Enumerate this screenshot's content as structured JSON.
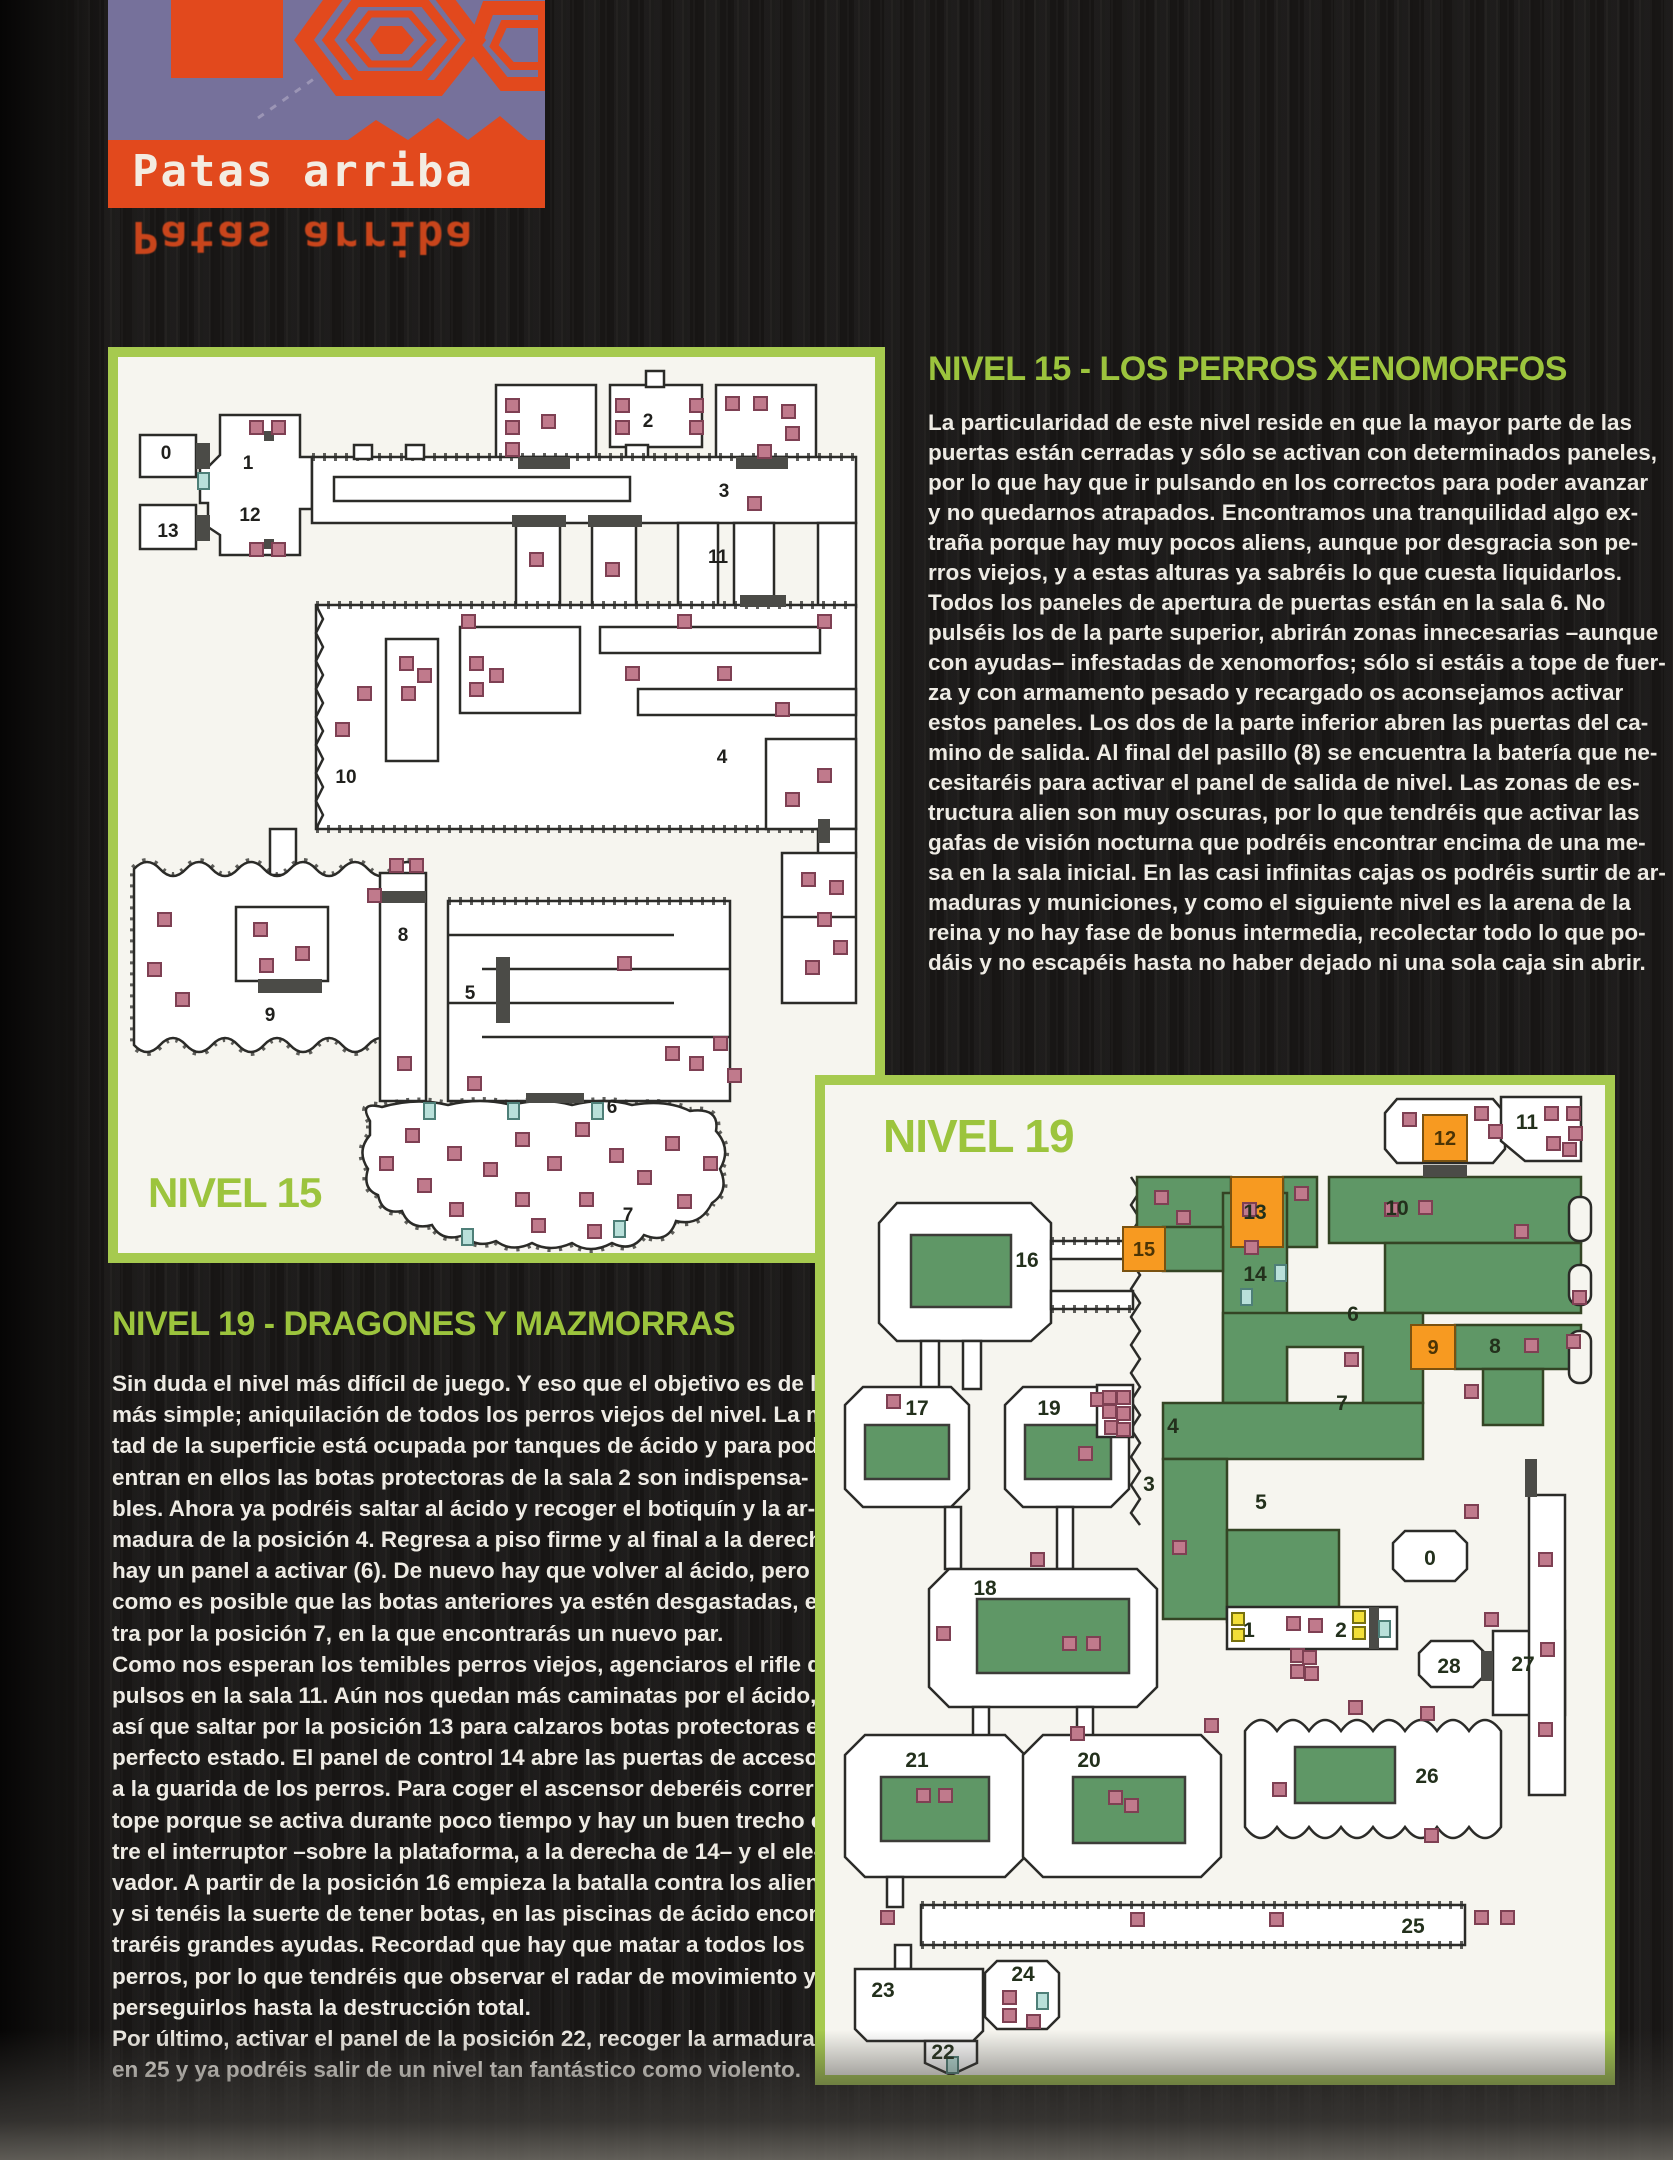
{
  "logo": {
    "title": "Patas arriba",
    "reflection": "Patas arriba"
  },
  "colors": {
    "accent_green": "#9cc43d",
    "map_frame_green": "#a6ca4f",
    "logo_orange": "#e2491d",
    "logo_purple": "#76719b",
    "acid_green": "#5f9766",
    "panel_orange": "#f79a21",
    "item_pink": "#c07a8c",
    "item_cyan": "#b9e0da",
    "item_yellow": "#f2df38",
    "body_text": "#eeebe4",
    "page_bg": "#1b1918"
  },
  "sections": {
    "nivel15": {
      "heading": "NIVEL 15 - LOS PERROS XENOMORFOS",
      "lines": [
        "La particularidad de este nivel reside en que la mayor parte de las",
        "puertas están cerradas y sólo se activan con determinados paneles,",
        "por lo que hay que ir pulsando en los correctos para poder avanzar",
        "y no quedarnos atrapados. Encontramos una tranquilidad algo ex-",
        "traña porque hay muy pocos aliens, aunque por desgracia son pe-",
        "rros viejos, y a estas alturas ya sabréis lo que cuesta liquidarlos.",
        "Todos los paneles de apertura de puertas están en la sala 6. No",
        "pulséis los de la parte superior, abrirán zonas innecesarias –aunque",
        "con ayudas– infestadas de xenomorfos; sólo si estáis a tope de fuer-",
        "za y con armamento pesado y recargado os aconsejamos activar",
        "estos paneles. Los dos de la parte inferior abren las puertas del ca-",
        "mino de salida. Al final del pasillo (8) se encuentra la batería que ne-",
        "cesitaréis para activar el panel de salida de nivel. Las zonas de es-",
        "tructura alien son muy oscuras, por lo que tendréis que activar las",
        "gafas de visión nocturna que podréis encontrar encima de una me-",
        "sa en la sala inicial. En las casi infinitas cajas os podréis surtir de ar-",
        "maduras y municiones, y como el siguiente nivel es la arena de la",
        "reina y no hay fase de bonus intermedia, recolectar todo lo que po-",
        "dáis y no escapéis hasta no haber dejado ni una sola caja sin abrir."
      ]
    },
    "nivel19": {
      "heading": "NIVEL 19 - DRAGONES Y MAZMORRAS",
      "lines": [
        "Sin duda el nivel más difícil de juego. Y eso que el objetivo es de lo",
        "más simple; aniquilación de todos los perros viejos del nivel. La mi-",
        "tad de la superficie está ocupada por tanques de ácido y para poder",
        "entran en ellos las botas protectoras de la sala 2 son indispensa-",
        "bles. Ahora ya podréis saltar al ácido y recoger el botiquín y la ar-",
        "madura de la posición 4. Regresa a piso firme y al final a la derecha",
        "hay un panel a activar (6). De nuevo hay que volver al ácido, pero",
        "como es posible que las botas anteriores ya estén desgastadas, en-",
        "tra por la posición 7, en la que encontrarás un nuevo par.",
        "Como nos esperan los temibles perros viejos, agenciaros el rifle de",
        "pulsos en la sala 11. Aún nos quedan más caminatas por el ácido,",
        "así que saltar por la posición 13 para calzaros botas protectoras en",
        "perfecto estado. El panel de control 14 abre las puertas de acceso",
        "a la guarida de los perros. Para coger el ascensor deberéis correr a",
        "tope porque se activa durante poco tiempo y hay un buen trecho en-",
        "tre el interruptor –sobre la plataforma, a la derecha de 14– y el ele-",
        "vador. A partir de la posición 16 empieza la batalla contra los aliens",
        "y si tenéis la suerte de tener botas, en las piscinas de ácido encon-",
        "traréis grandes ayudas. Recordad que hay que matar a todos los",
        "perros, por lo que tendréis que observar el radar de movimiento y",
        "perseguirlos hasta la destrucción total.",
        "Por último, activar el panel de la posición 22, recoger la armadura",
        "en 25 y ya podréis salir de un nivel tan fantástico como violento."
      ]
    }
  },
  "map15": {
    "label": "NIVEL 15",
    "rooms": [
      {
        "n": "0",
        "x": 48,
        "y": 102
      },
      {
        "n": "1",
        "x": 130,
        "y": 112
      },
      {
        "n": "12",
        "x": 132,
        "y": 164
      },
      {
        "n": "13",
        "x": 50,
        "y": 180
      },
      {
        "n": "2",
        "x": 530,
        "y": 70
      },
      {
        "n": "3",
        "x": 606,
        "y": 140
      },
      {
        "n": "11",
        "x": 600,
        "y": 206
      },
      {
        "n": "10",
        "x": 228,
        "y": 426
      },
      {
        "n": "4",
        "x": 604,
        "y": 406
      },
      {
        "n": "8",
        "x": 285,
        "y": 584
      },
      {
        "n": "9",
        "x": 152,
        "y": 664
      },
      {
        "n": "5",
        "x": 352,
        "y": 642
      },
      {
        "n": "6",
        "x": 494,
        "y": 756
      },
      {
        "n": "7",
        "x": 510,
        "y": 864
      }
    ],
    "doors": [
      [
        78,
        86,
        14,
        26
      ],
      [
        78,
        158,
        14,
        26
      ],
      [
        400,
        100,
        52,
        12
      ],
      [
        618,
        100,
        52,
        12
      ],
      [
        394,
        158,
        54,
        12
      ],
      [
        470,
        158,
        54,
        12
      ],
      [
        622,
        238,
        46,
        12
      ],
      [
        140,
        622,
        64,
        14
      ],
      [
        378,
        600,
        14,
        66
      ],
      [
        264,
        534,
        44,
        12
      ],
      [
        408,
        736,
        58,
        10
      ],
      [
        700,
        462,
        12,
        24
      ],
      [
        146,
        74,
        10,
        10
      ],
      [
        146,
        182,
        10,
        10
      ]
    ],
    "items_pink": [
      [
        132,
        64
      ],
      [
        154,
        64
      ],
      [
        132,
        186
      ],
      [
        154,
        186
      ],
      [
        388,
        42
      ],
      [
        388,
        64
      ],
      [
        388,
        86
      ],
      [
        424,
        58
      ],
      [
        498,
        42
      ],
      [
        498,
        64
      ],
      [
        572,
        42
      ],
      [
        572,
        64
      ],
      [
        608,
        40
      ],
      [
        636,
        40
      ],
      [
        664,
        48
      ],
      [
        668,
        70
      ],
      [
        640,
        88
      ],
      [
        630,
        140
      ],
      [
        412,
        196
      ],
      [
        488,
        206
      ],
      [
        344,
        258
      ],
      [
        560,
        258
      ],
      [
        700,
        258
      ],
      [
        282,
        300
      ],
      [
        284,
        330
      ],
      [
        300,
        312
      ],
      [
        352,
        300
      ],
      [
        352,
        326
      ],
      [
        372,
        312
      ],
      [
        508,
        310
      ],
      [
        600,
        310
      ],
      [
        658,
        346
      ],
      [
        700,
        412
      ],
      [
        668,
        436
      ],
      [
        240,
        330
      ],
      [
        218,
        366
      ],
      [
        684,
        516
      ],
      [
        712,
        524
      ],
      [
        700,
        556
      ],
      [
        716,
        584
      ],
      [
        688,
        604
      ],
      [
        40,
        556
      ],
      [
        30,
        606
      ],
      [
        58,
        636
      ],
      [
        136,
        566
      ],
      [
        178,
        590
      ],
      [
        142,
        602
      ],
      [
        250,
        532
      ],
      [
        272,
        502
      ],
      [
        292,
        502
      ],
      [
        280,
        700
      ],
      [
        500,
        600
      ],
      [
        548,
        690
      ],
      [
        572,
        700
      ],
      [
        596,
        680
      ],
      [
        610,
        712
      ],
      [
        350,
        720
      ],
      [
        262,
        800
      ],
      [
        288,
        772
      ],
      [
        300,
        822
      ],
      [
        330,
        790
      ],
      [
        332,
        846
      ],
      [
        366,
        806
      ],
      [
        398,
        776
      ],
      [
        398,
        836
      ],
      [
        430,
        800
      ],
      [
        458,
        766
      ],
      [
        462,
        836
      ],
      [
        492,
        792
      ],
      [
        520,
        814
      ],
      [
        548,
        780
      ],
      [
        560,
        838
      ],
      [
        586,
        800
      ],
      [
        414,
        862
      ],
      [
        470,
        868
      ]
    ],
    "items_cyan": [
      [
        80,
        116
      ],
      [
        306,
        746
      ],
      [
        390,
        746
      ],
      [
        474,
        746
      ],
      [
        344,
        872
      ],
      [
        496,
        864
      ]
    ]
  },
  "map19": {
    "label": "NIVEL 19",
    "rooms": [
      {
        "n": "16",
        "x": 202,
        "y": 182
      },
      {
        "n": "17",
        "x": 92,
        "y": 330
      },
      {
        "n": "19",
        "x": 224,
        "y": 330
      },
      {
        "n": "18",
        "x": 160,
        "y": 510
      },
      {
        "n": "21",
        "x": 92,
        "y": 682
      },
      {
        "n": "20",
        "x": 264,
        "y": 682
      },
      {
        "n": "23",
        "x": 58,
        "y": 912
      },
      {
        "n": "24",
        "x": 198,
        "y": 896
      },
      {
        "n": "22",
        "x": 118,
        "y": 974
      },
      {
        "n": "25",
        "x": 588,
        "y": 848
      },
      {
        "n": "0",
        "x": 605,
        "y": 480
      },
      {
        "n": "1",
        "x": 424,
        "y": 552
      },
      {
        "n": "2",
        "x": 516,
        "y": 552
      },
      {
        "n": "28",
        "x": 624,
        "y": 588
      },
      {
        "n": "27",
        "x": 698,
        "y": 586
      },
      {
        "n": "26",
        "x": 602,
        "y": 698
      },
      {
        "n": "10",
        "x": 572,
        "y": 130
      },
      {
        "n": "13",
        "x": 430,
        "y": 134
      },
      {
        "n": "14",
        "x": 430,
        "y": 196
      },
      {
        "n": "6",
        "x": 528,
        "y": 236
      },
      {
        "n": "8",
        "x": 670,
        "y": 268
      },
      {
        "n": "11",
        "x": 702,
        "y": 44
      },
      {
        "n": "3",
        "x": 324,
        "y": 406
      },
      {
        "n": "4",
        "x": 348,
        "y": 348
      },
      {
        "n": "5",
        "x": 436,
        "y": 424
      },
      {
        "n": "7",
        "x": 517,
        "y": 325
      }
    ],
    "panels": [
      {
        "n": "15",
        "x": 298,
        "y": 142,
        "w": 42,
        "h": 44
      },
      {
        "n": "12",
        "x": 598,
        "y": 30,
        "w": 44,
        "h": 46
      },
      {
        "n": "9",
        "x": 586,
        "y": 240,
        "w": 44,
        "h": 44
      },
      {
        "n": "",
        "x": 406,
        "y": 92,
        "w": 52,
        "h": 70
      }
    ],
    "doors": [
      [
        544,
        522,
        10,
        42
      ],
      [
        656,
        566,
        12,
        30
      ],
      [
        598,
        80,
        44,
        12
      ],
      [
        700,
        374,
        12,
        38
      ]
    ],
    "items_pink": [
      [
        62,
        310
      ],
      [
        266,
        308
      ],
      [
        254,
        362
      ],
      [
        92,
        704
      ],
      [
        114,
        704
      ],
      [
        284,
        706
      ],
      [
        300,
        714
      ],
      [
        238,
        552
      ],
      [
        262,
        552
      ],
      [
        206,
        468
      ],
      [
        112,
        542
      ],
      [
        380,
        634
      ],
      [
        246,
        642
      ],
      [
        178,
        906
      ],
      [
        178,
        924
      ],
      [
        202,
        930
      ],
      [
        306,
        828
      ],
      [
        445,
        828
      ],
      [
        650,
        826
      ],
      [
        676,
        826
      ],
      [
        56,
        826
      ],
      [
        278,
        306
      ],
      [
        292,
        306
      ],
      [
        278,
        320
      ],
      [
        292,
        322
      ],
      [
        280,
        336
      ],
      [
        292,
        338
      ],
      [
        330,
        106
      ],
      [
        352,
        126
      ],
      [
        470,
        102
      ],
      [
        560,
        118
      ],
      [
        418,
        118
      ],
      [
        420,
        156
      ],
      [
        520,
        268
      ],
      [
        578,
        28
      ],
      [
        650,
        22
      ],
      [
        664,
        40
      ],
      [
        720,
        22
      ],
      [
        742,
        22
      ],
      [
        744,
        42
      ],
      [
        722,
        52
      ],
      [
        738,
        58
      ],
      [
        700,
        254
      ],
      [
        742,
        250
      ],
      [
        640,
        300
      ],
      [
        594,
        116
      ],
      [
        690,
        140
      ],
      [
        748,
        206
      ],
      [
        640,
        420
      ],
      [
        348,
        456
      ],
      [
        462,
        532
      ],
      [
        484,
        534
      ],
      [
        466,
        564
      ],
      [
        478,
        566
      ],
      [
        466,
        580
      ],
      [
        480,
        582
      ],
      [
        714,
        468
      ],
      [
        716,
        558
      ],
      [
        714,
        638
      ],
      [
        660,
        528
      ],
      [
        448,
        698
      ],
      [
        600,
        744
      ],
      [
        524,
        616
      ],
      [
        596,
        622
      ]
    ],
    "items_cyan": [
      [
        450,
        180
      ],
      [
        416,
        204
      ],
      [
        554,
        536
      ],
      [
        212,
        908
      ],
      [
        122,
        972
      ]
    ],
    "items_yellow": [
      [
        407,
        528
      ],
      [
        407,
        544
      ],
      [
        528,
        526
      ],
      [
        528,
        542
      ]
    ]
  }
}
